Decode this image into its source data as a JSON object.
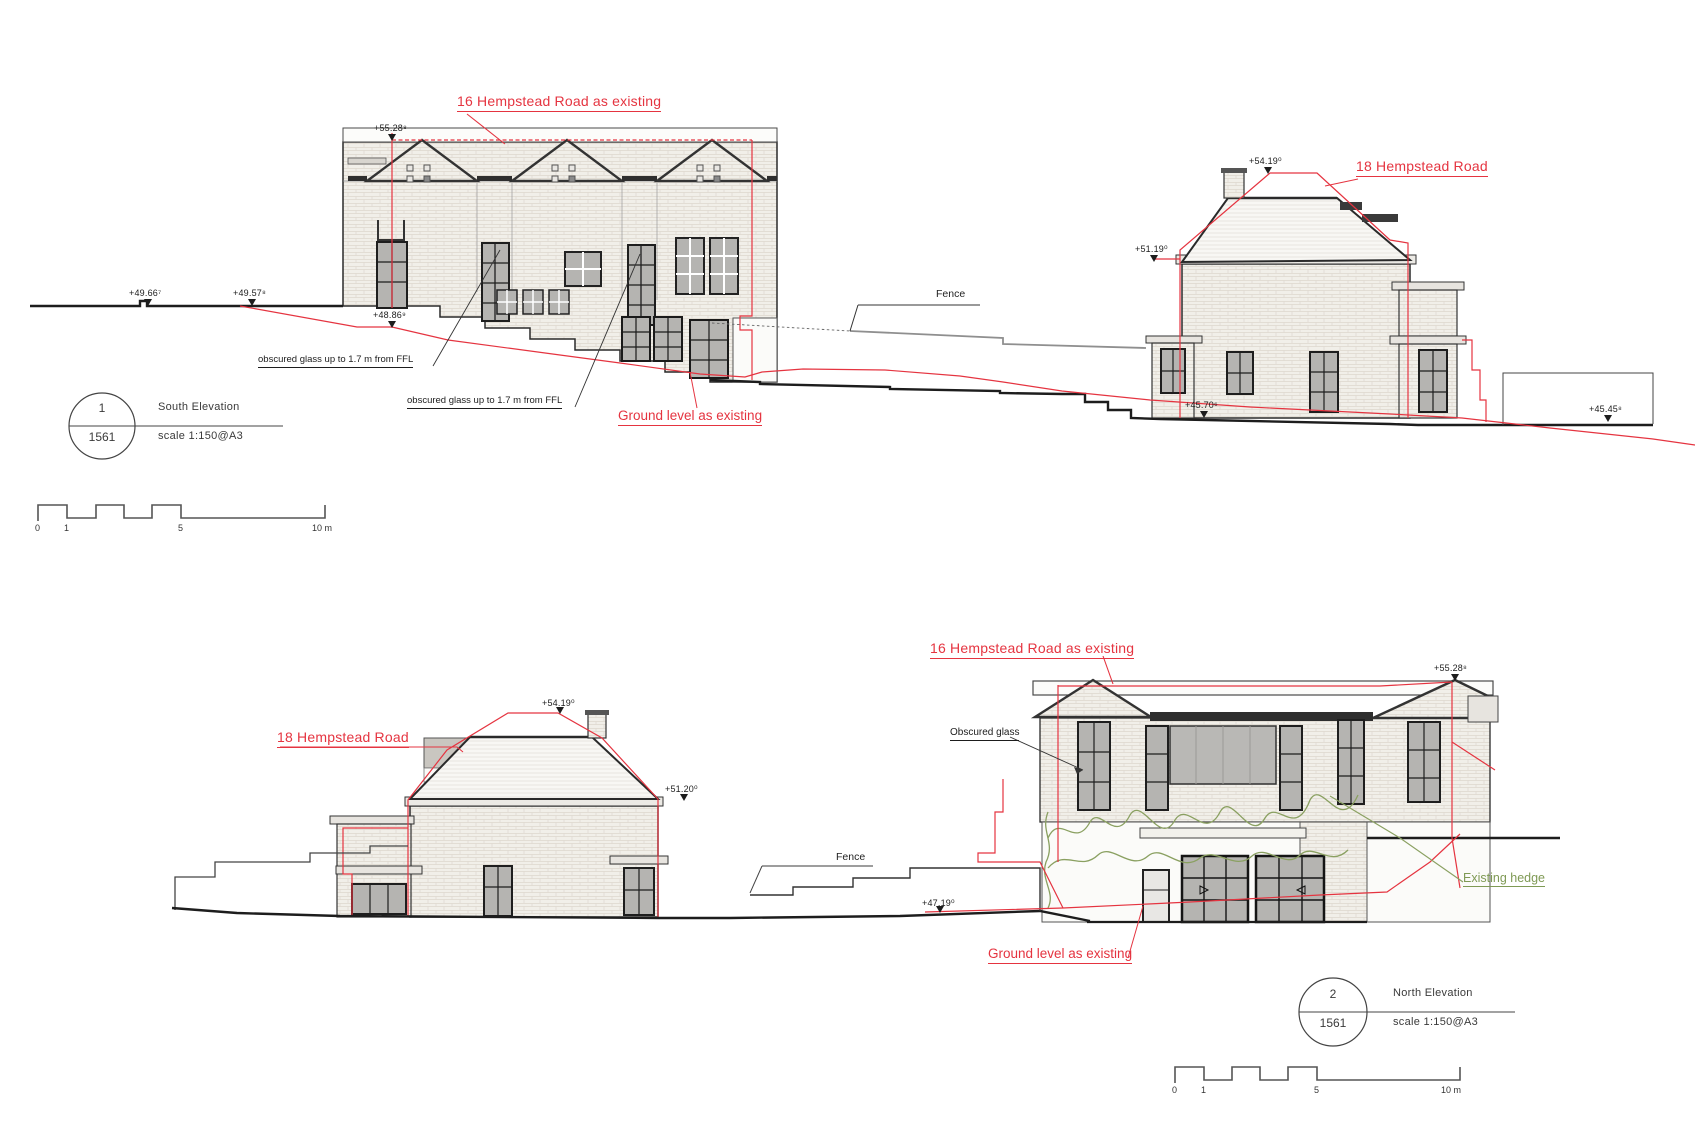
{
  "colors": {
    "annotation_red": "#e53440",
    "hedge_green": "#7f9a55",
    "ink": "#2a2a2a",
    "fence_gray": "#8f8f8f"
  },
  "south": {
    "house16_label": "16 Hempstead Road as existing",
    "house18_label": "18 Hempstead Road",
    "fence_label": "Fence",
    "ground_label": "Ground level as existing",
    "obscured_glass_label_1": "obscured glass up to 1.7 m from FFL",
    "obscured_glass_label_2": "obscured glass up to 1.7 m from FFL",
    "levels": {
      "ridge16": "+55.28⁸",
      "ground_a": "+49.66⁷",
      "ground_b": "+49.57⁸",
      "ground_c": "+48.86⁹",
      "ridge18": "+54.19⁰",
      "eaves18": "+51.19⁰",
      "ground_d": "+45.70⁶",
      "ground_e": "+45.45⁸"
    },
    "title_block": {
      "drawing_number": "1",
      "sheet_number": "1561",
      "title": "South Elevation",
      "scale": "scale 1:150@A3"
    },
    "scale_bar": {
      "zero": "0",
      "one": "1",
      "five": "5",
      "ten": "10 m"
    }
  },
  "north": {
    "house18_label": "18 Hempstead Road",
    "house16_label": "16 Hempstead Road as existing",
    "fence_label": "Fence",
    "ground_label": "Ground level as existing",
    "obscured_glass_label": "Obscured glass",
    "hedge_label": "Existing hedge",
    "levels": {
      "ridge18": "+54.19⁰",
      "eaves18": "+51.20⁰",
      "ridge16": "+55.28⁸",
      "ground_a": "+47.19⁰"
    },
    "title_block": {
      "drawing_number": "2",
      "sheet_number": "1561",
      "title": "North Elevation",
      "scale": "scale 1:150@A3"
    },
    "scale_bar": {
      "zero": "0",
      "one": "1",
      "five": "5",
      "ten": "10 m"
    }
  }
}
